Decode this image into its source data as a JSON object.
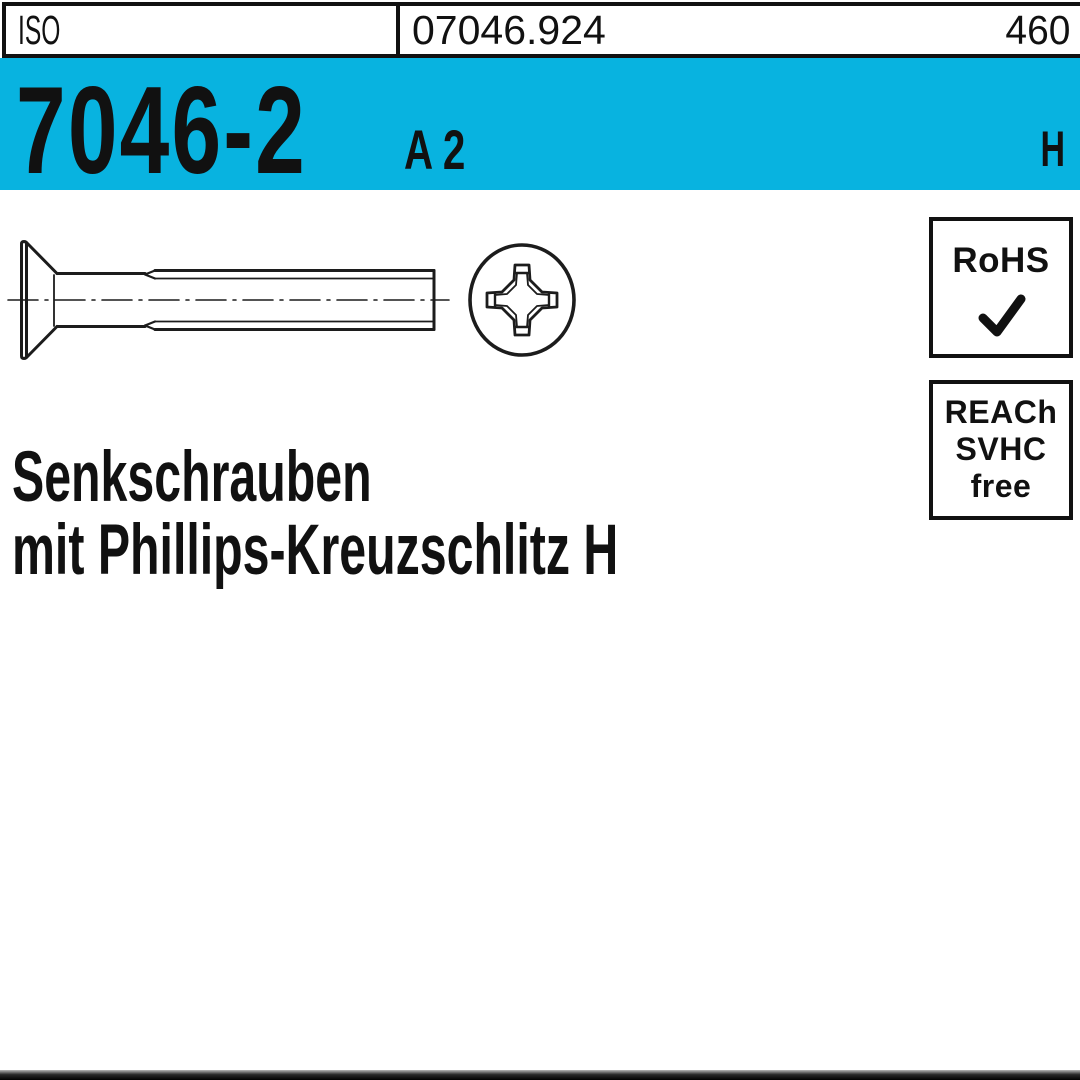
{
  "header": {
    "standard_org": "ISO",
    "article_number": "07046.924",
    "right_number": "460"
  },
  "banner": {
    "standard_number": "7046-2",
    "material_grade": "A 2",
    "drive_letter": "H"
  },
  "badges": {
    "rohs": {
      "label": "RoHS",
      "icon": "check-icon"
    },
    "reach": {
      "line1": "REACh",
      "line2": "SVHC",
      "line3": "free"
    }
  },
  "product": {
    "title_line1": "Senkschrauben",
    "title_line2": "mit Phillips-Kreuzschlitz H"
  },
  "drawing": {
    "side_view_icon": "countersunk-screw-side-view-icon",
    "front_view_icon": "phillips-recess-front-view-icon"
  },
  "colors": {
    "accent_cyan": "#08b3e0",
    "ink": "#111111"
  }
}
